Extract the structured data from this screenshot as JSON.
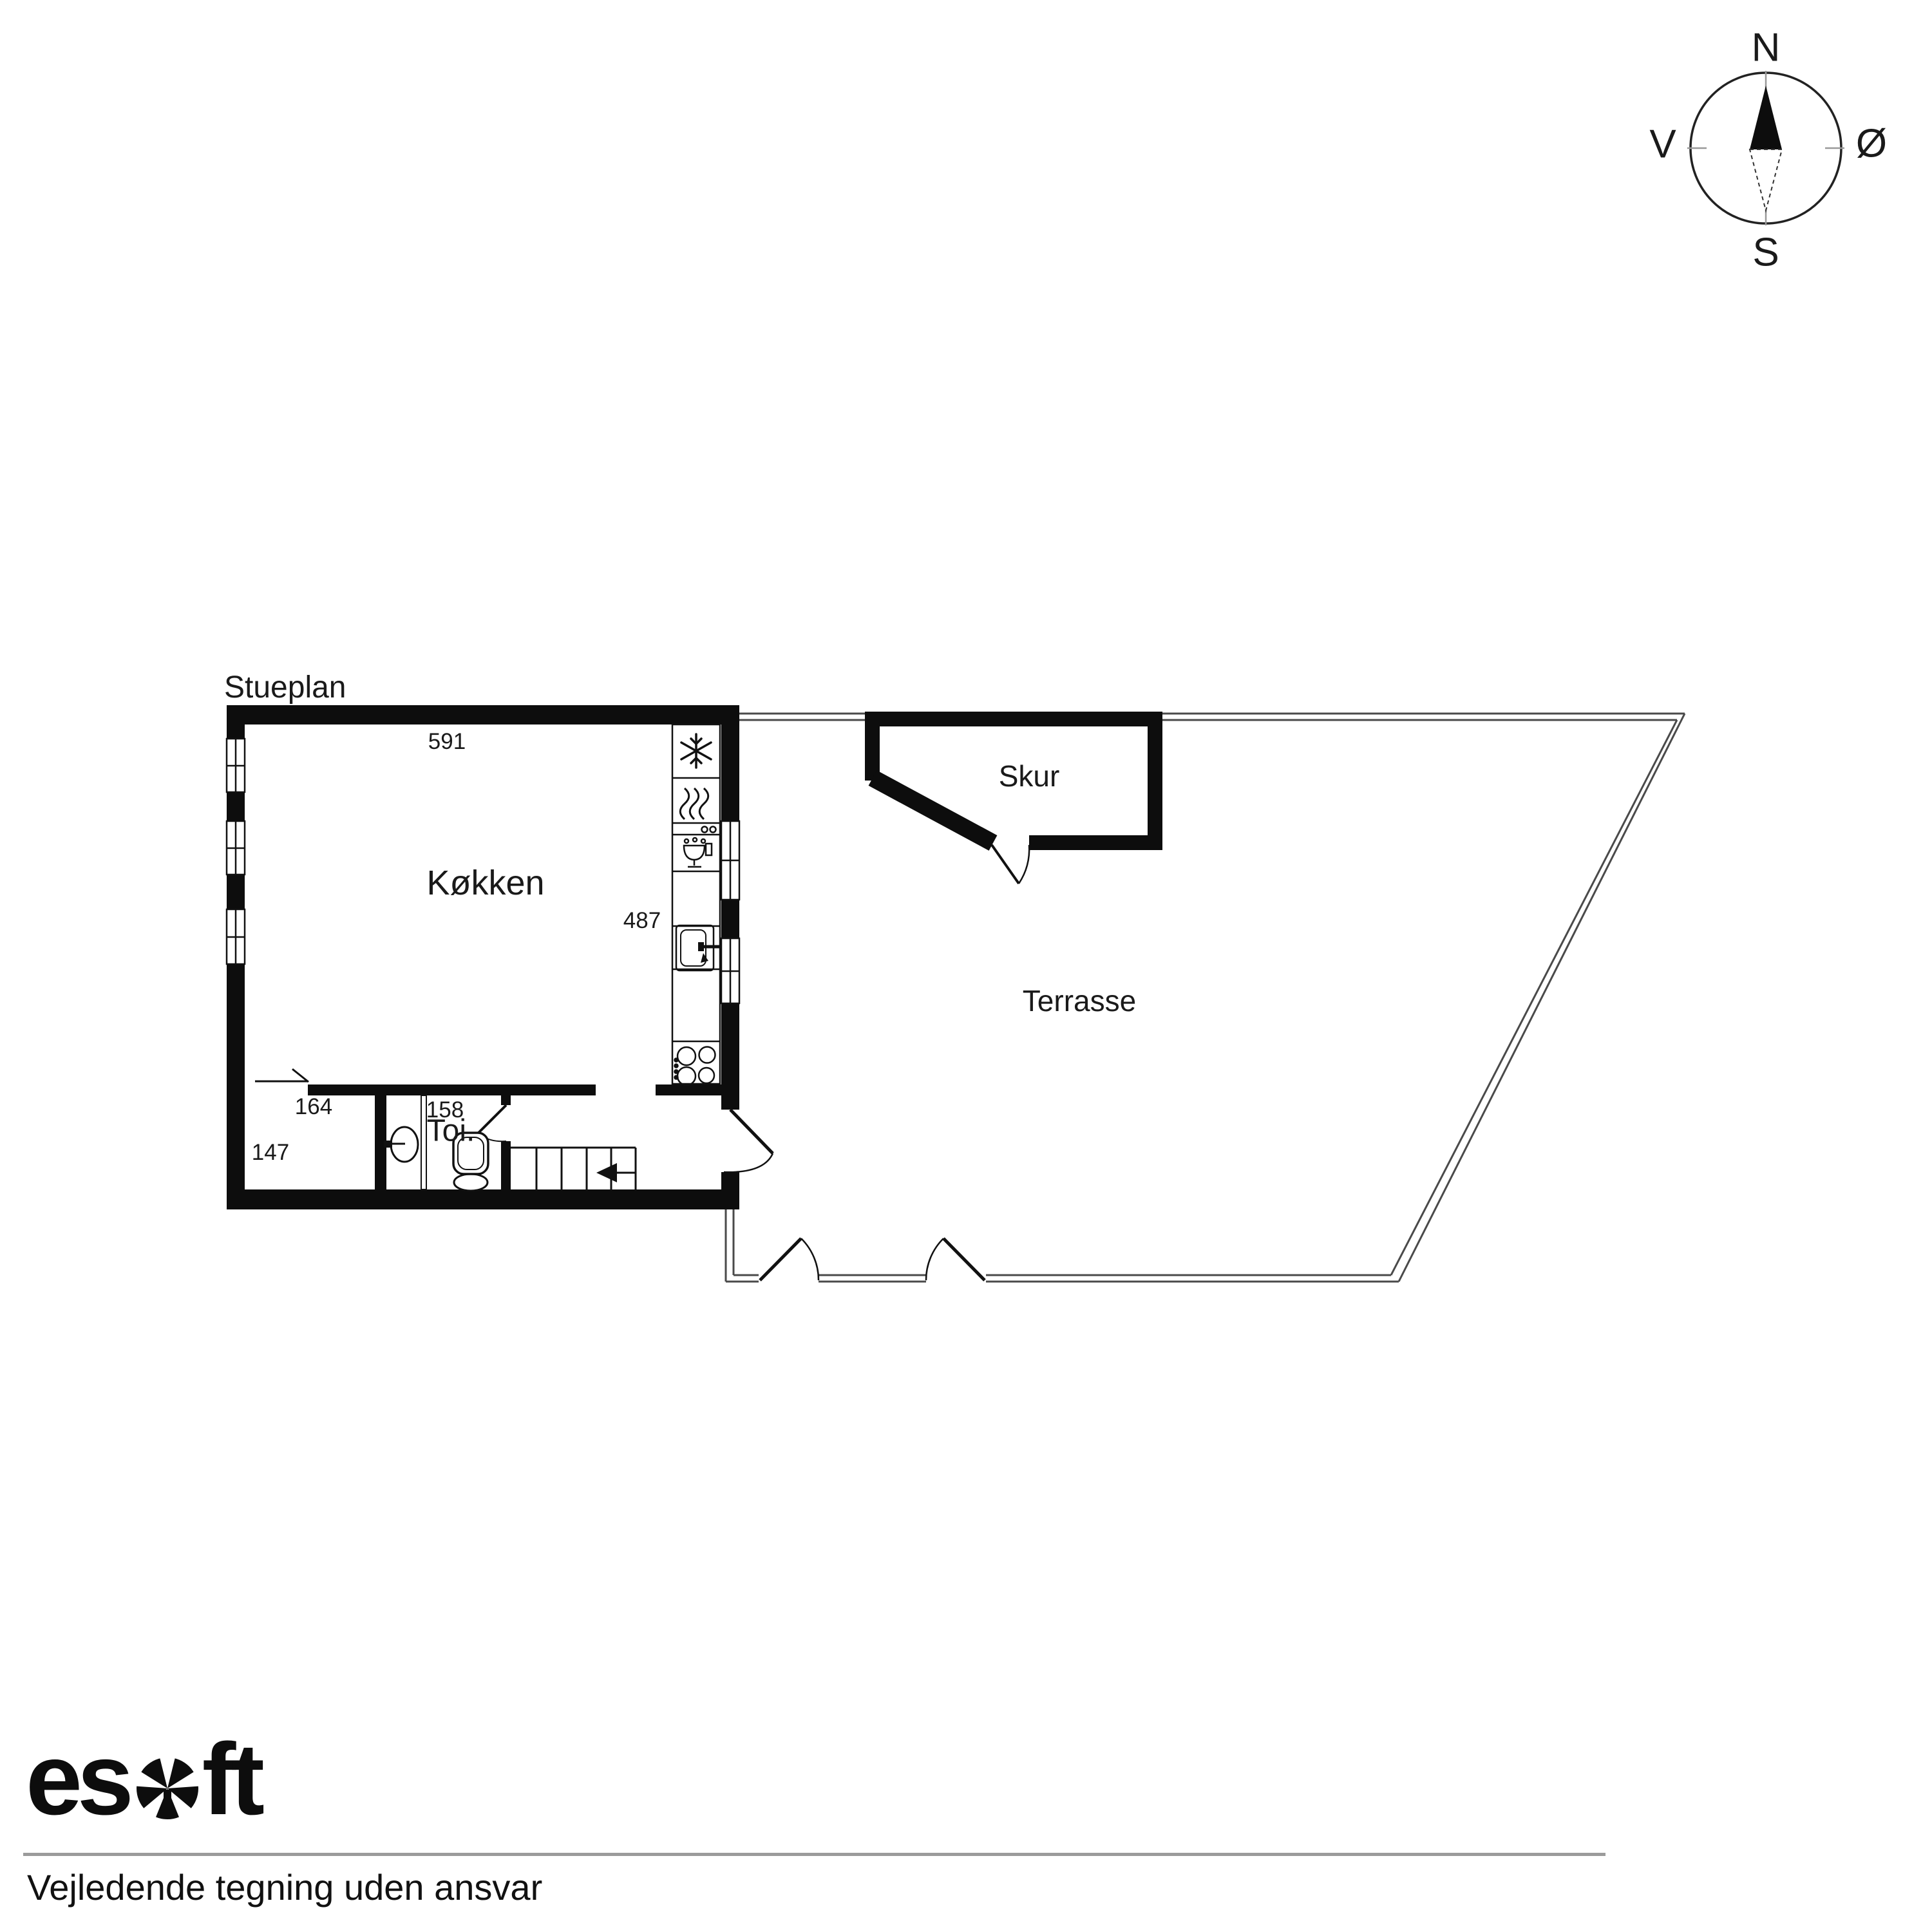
{
  "title": "Stueplan",
  "compass": {
    "north": "N",
    "east": "Ø",
    "south": "S",
    "west": "V"
  },
  "rooms": {
    "kitchen": {
      "label": "Køkken",
      "width_cm": "591",
      "depth_cm": "487"
    },
    "utility": {
      "width_cm": "164",
      "depth_cm": "147"
    },
    "toilet": {
      "label": "Toi.",
      "width_cm": "158"
    },
    "shed": {
      "label": "Skur"
    },
    "terrace": {
      "label": "Terrasse"
    }
  },
  "footer": {
    "logo_es": "es",
    "logo_ft": "ft",
    "disclaimer": "Vejledende tegning uden ansvar"
  },
  "colors": {
    "wall": "#0d0d0d",
    "divider_line": "#9b9b9b",
    "boundary": "#4a4a4a"
  }
}
